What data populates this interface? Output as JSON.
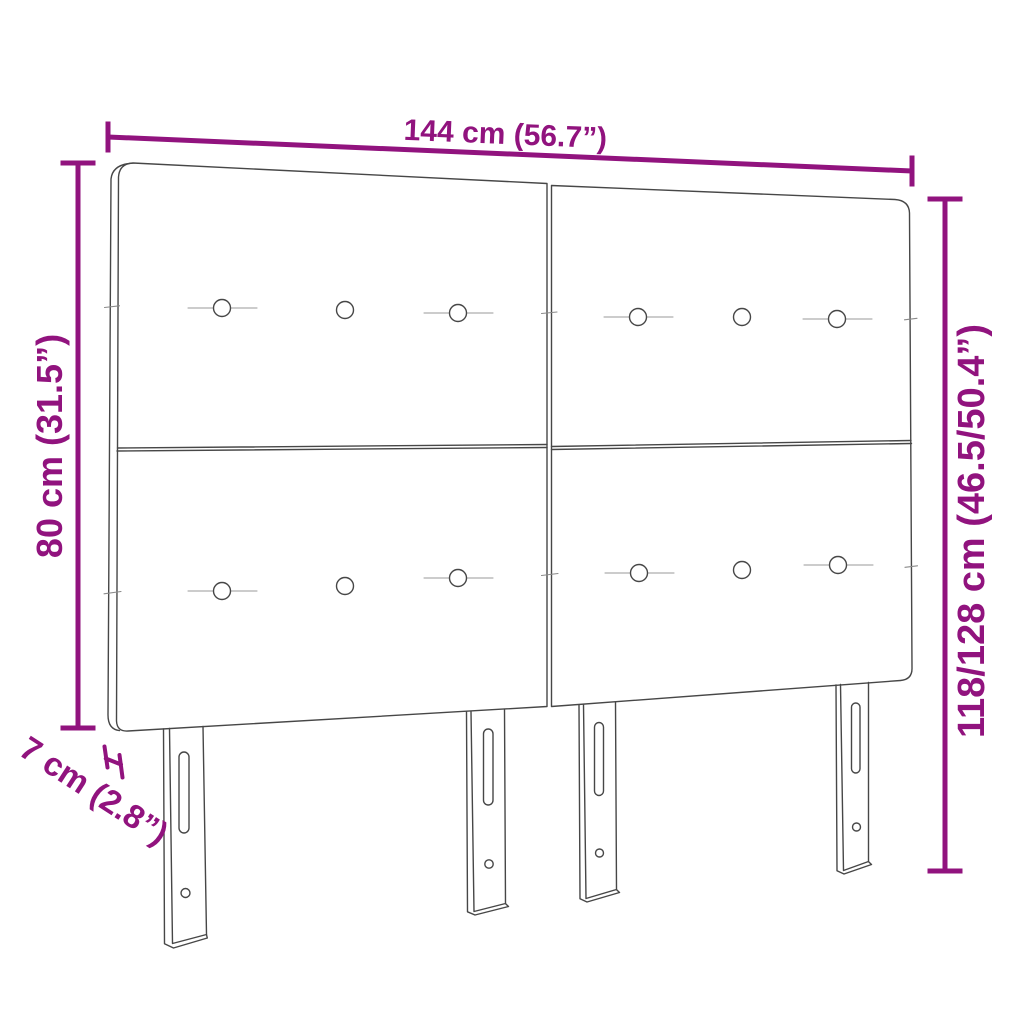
{
  "diagram": {
    "subject": "upholstered headboard with four panels and four slotted legs",
    "annotations": {
      "width": "144 cm (56.7”)",
      "panel_height": "80 cm (31.5”)",
      "total_height": "118/128 cm (46.5/50.4”)",
      "depth": "7 cm (2.8”)"
    },
    "colors": {
      "dimension_accent": "#91137E",
      "outline": "#474747",
      "background": "#FFFFFF"
    },
    "features": {
      "panels": 4,
      "upholstery_buttons": 12,
      "legs": 4
    }
  }
}
